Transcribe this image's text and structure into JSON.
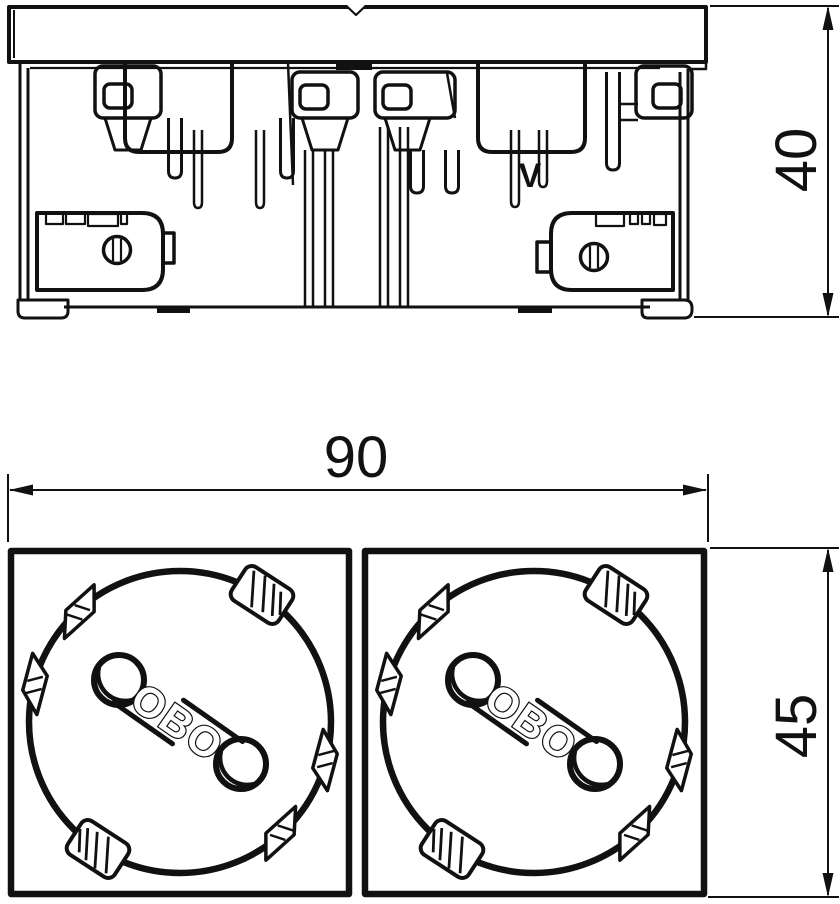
{
  "side_view": {
    "marking": "V",
    "dim_height": "40"
  },
  "front_view": {
    "dim_width": "90",
    "dim_height": "45",
    "sockets": [
      {
        "logo": "OBO"
      },
      {
        "logo": "OBO"
      }
    ]
  },
  "colors": {
    "line": "#111111",
    "background": "#ffffff"
  }
}
